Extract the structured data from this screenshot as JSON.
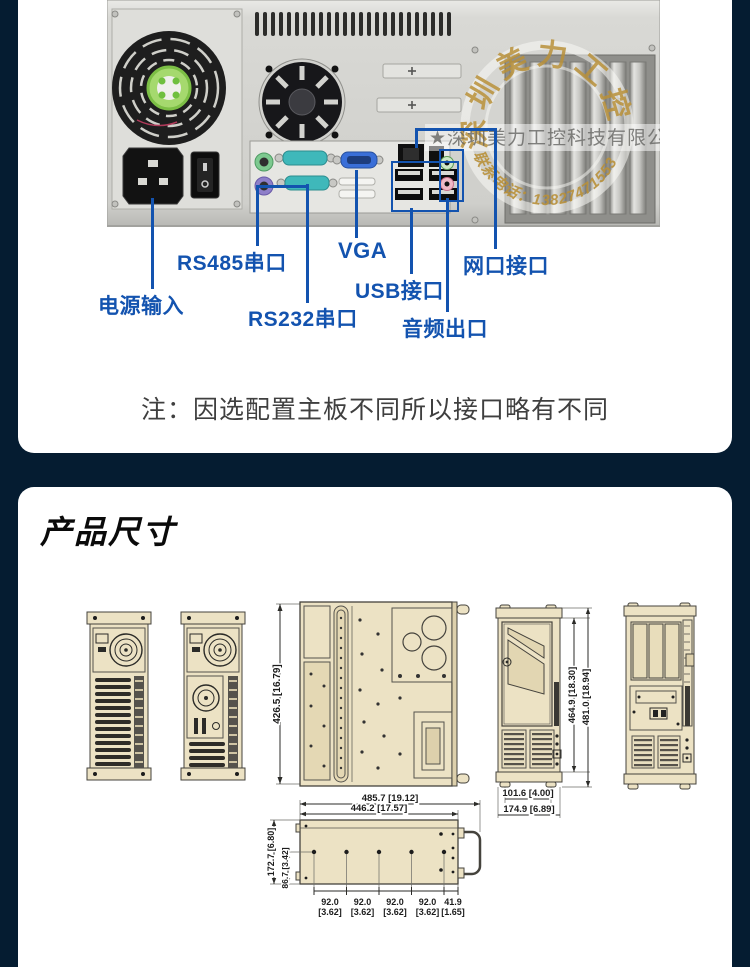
{
  "rear": {
    "labels": {
      "power": "电源输入",
      "rs485": "RS485串口",
      "rs232": "RS232串口",
      "vga": "VGA",
      "usb": "USB接口",
      "audio": "音频出口",
      "lan": "网口接口"
    },
    "note": "注：因选配置主板不同所以接口略有不同",
    "watermark": {
      "company": "★深圳美力工控科技有限公司 ★",
      "stamp": "深圳美力工控",
      "phone": "联系电话：13827471553"
    }
  },
  "dims": {
    "title": "产品尺寸",
    "top_view_h": "426.5 [16.79]",
    "front_h1": "464.9 [18.30]",
    "front_h2": "481.0 [18.94]",
    "front_w1": "101.6 [4.00]",
    "front_w2": "174.9 [6.89]",
    "side_w1": "485.7 [19.12]",
    "side_w2": "446.2 [17.57]",
    "side_h1": "172.7 [6.80]",
    "side_h2": "86.7 [3.42]",
    "holes_mm": [
      "92.0",
      "92.0",
      "92.0",
      "92.0",
      "41.9"
    ],
    "holes_in": [
      "[3.62]",
      "[3.62]",
      "[3.62]",
      "[3.62]",
      "[1.65]"
    ]
  },
  "colors": {
    "background": "#051c31",
    "accent_blue": "#1353af",
    "drawing_beige": "#ece2c4",
    "watermark_gold": "#b8903a"
  }
}
